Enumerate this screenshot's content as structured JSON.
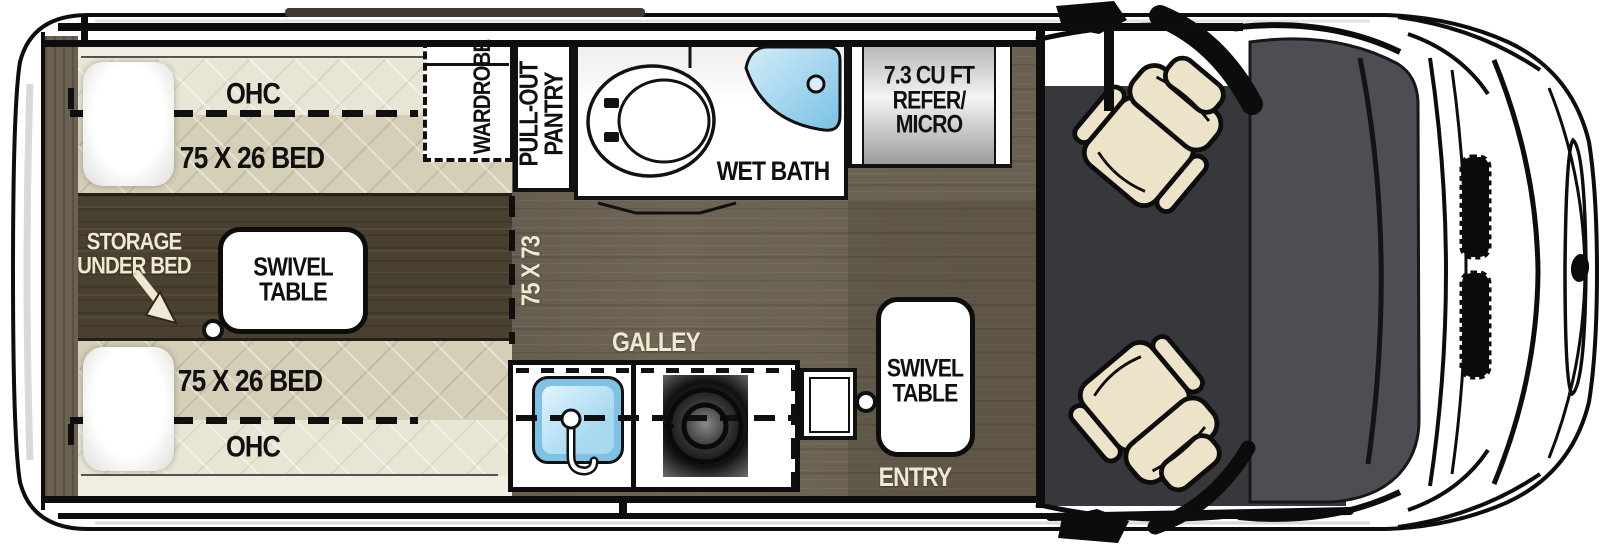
{
  "title": "Camper van floor plan (top view)",
  "labels": {
    "ohc": "OHC",
    "bed_size": "75 X 26 BED",
    "wardrobe": "WARDROBE",
    "pantry_1": "PULL-OUT",
    "pantry_2": "PANTRY",
    "wet_bath": "WET BATH",
    "refer_1": "7.3 CU FT",
    "refer_2": "REFER/",
    "refer_3": "MICRO",
    "storage_1": "STORAGE",
    "storage_2": "UNDER BED",
    "swivel_1": "SWIVEL",
    "swivel_2": "TABLE",
    "dimension": "75 X 73",
    "galley": "GALLEY",
    "entry": "ENTRY"
  },
  "colors": {
    "line": "#0d0d0d",
    "floor_main": "#6e6555",
    "floor_aisle": "#49402f",
    "bed_quilt": "#d5cfb8",
    "bed_quilt_light": "#e9e5d5",
    "seat": "#ece3c8",
    "cab_floor": "#38373c",
    "windshield": "#4d4d54",
    "shower_blue": "#8fcbe9",
    "sink_blue": "#7fc2e4",
    "label_cream": "#efe8d2"
  }
}
